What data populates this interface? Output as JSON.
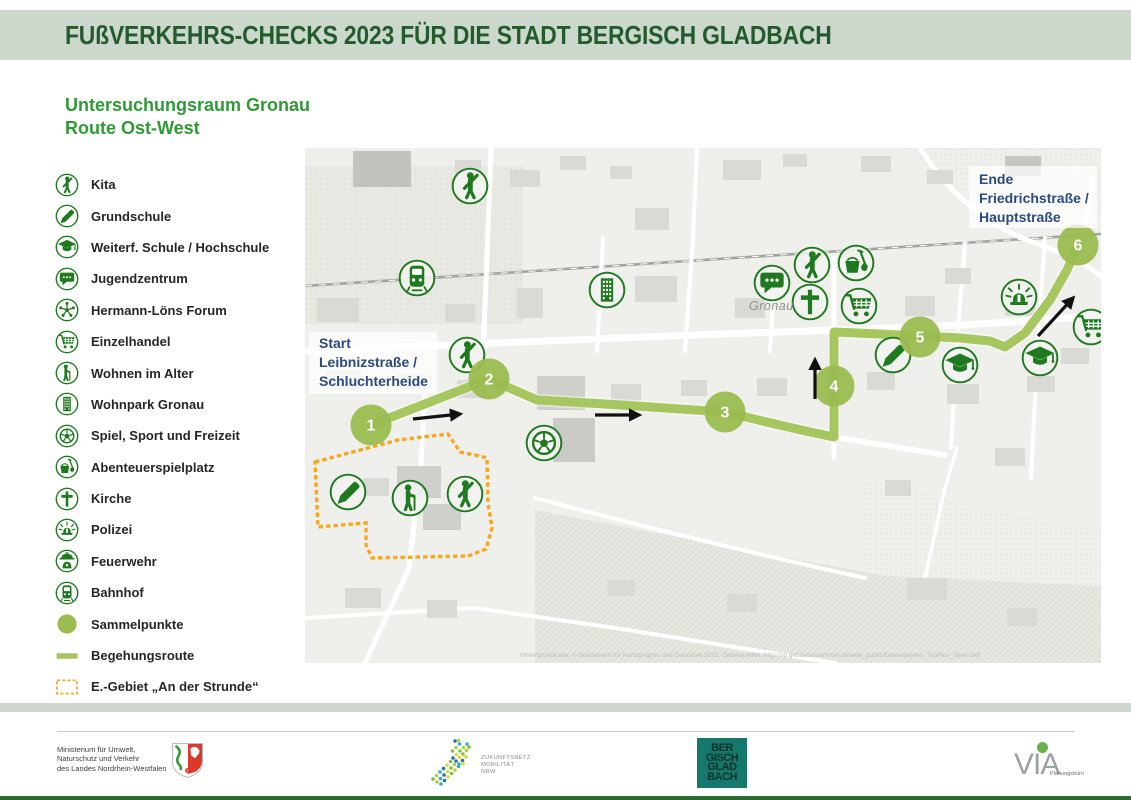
{
  "page": {
    "title_banner": "FUßVERKEHRS-CHECKS 2023 FÜR DIE STADT BERGISCH GLADBACH"
  },
  "subtitle": {
    "line1": "Untersuchungsraum Gronau",
    "line2": "Route Ost-West"
  },
  "legend": {
    "items": [
      {
        "icon": "kita",
        "label": "Kita"
      },
      {
        "icon": "grundschule",
        "label": "Grundschule"
      },
      {
        "icon": "weiterf-schule",
        "label": "Weiterf. Schule / Hochschule"
      },
      {
        "icon": "jugendzentrum",
        "label": "Jugendzentrum"
      },
      {
        "icon": "hermann-loens-forum",
        "label": "Hermann-Löns Forum"
      },
      {
        "icon": "einzelhandel",
        "label": "Einzelhandel"
      },
      {
        "icon": "wohnen-im-alter",
        "label": "Wohnen im Alter"
      },
      {
        "icon": "wohnpark-gronau",
        "label": "Wohnpark Gronau"
      },
      {
        "icon": "spiel-sport-freizeit",
        "label": "Spiel, Sport und Freizeit"
      },
      {
        "icon": "abenteuerspielplatz",
        "label": "Abenteuerspielplatz"
      },
      {
        "icon": "kirche",
        "label": "Kirche"
      },
      {
        "icon": "polizei",
        "label": "Polizei"
      },
      {
        "icon": "feuerwehr",
        "label": "Feuerwehr"
      },
      {
        "icon": "bahnhof",
        "label": "Bahnhof"
      },
      {
        "icon": "sammelpunkte",
        "label": "Sammelpunkte"
      },
      {
        "icon": "begehungsroute",
        "label": "Begehungsroute"
      },
      {
        "icon": "e-gebiet",
        "label": "E.-Gebiet „An der Strunde“"
      }
    ]
  },
  "map": {
    "start_label": {
      "lines": [
        "Start",
        "Leibnizstraße /",
        "Schluchterheide"
      ]
    },
    "end_label": {
      "lines": [
        "Ende",
        "Friedrichstraße /",
        "Hauptstraße"
      ]
    },
    "district_label": "Gronau",
    "attribution": "Hintergrundkarte: © Bundesamt für Kartographie und Geodäsie 2022, Datenquellen: http://sg.geodatenzentrum.de/web_public/Datenquellen_TopPlus_Open.pdf",
    "waypoints": [
      {
        "n": "1",
        "x": 66,
        "y": 277
      },
      {
        "n": "2",
        "x": 184,
        "y": 231
      },
      {
        "n": "3",
        "x": 420,
        "y": 264
      },
      {
        "n": "4",
        "x": 529,
        "y": 238
      },
      {
        "n": "5",
        "x": 615,
        "y": 189
      },
      {
        "n": "6",
        "x": 773,
        "y": 97
      }
    ],
    "route": [
      [
        66,
        277
      ],
      [
        184,
        231
      ],
      [
        232,
        252
      ],
      [
        300,
        256
      ],
      [
        360,
        260
      ],
      [
        420,
        264
      ],
      [
        470,
        276
      ],
      [
        505,
        284
      ],
      [
        529,
        289
      ],
      [
        529,
        184
      ],
      [
        575,
        186
      ],
      [
        615,
        188
      ],
      [
        655,
        190
      ],
      [
        685,
        193
      ],
      [
        700,
        199
      ],
      [
        720,
        185
      ],
      [
        745,
        152
      ],
      [
        762,
        122
      ],
      [
        773,
        97
      ]
    ],
    "route_arrows": [
      {
        "x1": 108,
        "y1": 271,
        "x2": 155,
        "y2": 266
      },
      {
        "x1": 290,
        "y1": 267,
        "x2": 334,
        "y2": 267
      },
      {
        "x1": 510,
        "y1": 251,
        "x2": 510,
        "y2": 212
      },
      {
        "x1": 733,
        "y1": 188,
        "x2": 768,
        "y2": 150
      }
    ],
    "pois": [
      {
        "icon": "kita",
        "x": 165,
        "y": 38
      },
      {
        "icon": "bahnhof",
        "x": 112,
        "y": 130
      },
      {
        "icon": "wohnpark-gronau",
        "x": 302,
        "y": 142
      },
      {
        "icon": "kita",
        "x": 162,
        "y": 207
      },
      {
        "icon": "grundschule",
        "x": 43,
        "y": 344
      },
      {
        "icon": "wohnen-im-alter",
        "x": 105,
        "y": 350
      },
      {
        "icon": "kita",
        "x": 160,
        "y": 346
      },
      {
        "icon": "spiel-sport-freizeit",
        "x": 239,
        "y": 295
      },
      {
        "icon": "jugendzentrum",
        "x": 467,
        "y": 135
      },
      {
        "icon": "kita",
        "x": 507,
        "y": 117
      },
      {
        "icon": "abenteuerspielplatz",
        "x": 551,
        "y": 115
      },
      {
        "icon": "kirche",
        "x": 505,
        "y": 154
      },
      {
        "icon": "einzelhandel",
        "x": 554,
        "y": 158
      },
      {
        "icon": "grundschule",
        "x": 588,
        "y": 207
      },
      {
        "icon": "weiterf-schule",
        "x": 655,
        "y": 217
      },
      {
        "icon": "polizei",
        "x": 714,
        "y": 149
      },
      {
        "icon": "weiterf-schule",
        "x": 735,
        "y": 210
      },
      {
        "icon": "einzelhandel",
        "x": 786,
        "y": 179
      }
    ],
    "egebiet_polygon": [
      [
        10,
        314
      ],
      [
        93,
        292
      ],
      [
        143,
        286
      ],
      [
        155,
        304
      ],
      [
        170,
        307
      ],
      [
        182,
        310
      ],
      [
        183,
        355
      ],
      [
        187,
        380
      ],
      [
        181,
        401
      ],
      [
        163,
        408
      ],
      [
        67,
        410
      ],
      [
        61,
        397
      ],
      [
        61,
        375
      ],
      [
        13,
        379
      ]
    ]
  },
  "footer": {
    "ministry": {
      "lines": [
        "Ministerium für Umwelt,",
        "Naturschutz und Verkehr",
        "des Landes Nordrhein-Westfalen"
      ]
    },
    "zukunftsnetz": {
      "lines": [
        "ZUKUNFTSNETZ",
        "MOBILITÄT",
        "NRW"
      ]
    },
    "bergisch_gladbach": {
      "lines": [
        "BER",
        "GISCH",
        "GLAD",
        "BACH"
      ]
    },
    "via": {
      "label": "VIA",
      "sub": "Planungsbüro"
    }
  },
  "colors": {
    "banner_bg": "#ccd8cb",
    "banner_text": "#235c2c",
    "subtitle_green": "#2f9b35",
    "icon_green": "#1f7a1f",
    "route_green": "#a6c75f",
    "waypoint_green": "#9abc50",
    "egebiet_orange": "#f6a823",
    "label_blue": "#2b4a7d"
  }
}
